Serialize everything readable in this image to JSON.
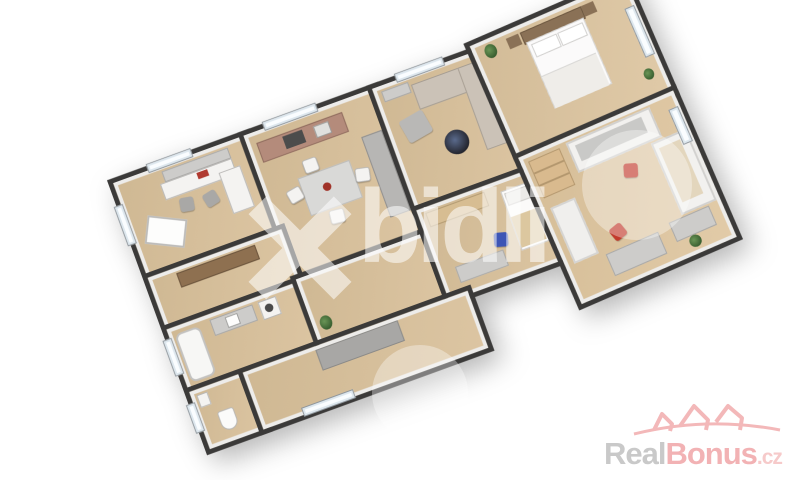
{
  "watermark": {
    "text": "bidli",
    "color": "#ffffff",
    "opacity": 0.55,
    "mark": "pinwheel-x-icon"
  },
  "logo": {
    "real": "Real",
    "bonus": "Bonus",
    "tld": ".cz",
    "real_color": "#c9c9c9",
    "bonus_color": "#f2b2b4",
    "tld_color": "#f6caca",
    "houses_color": "#f3b8b9",
    "icon": "three-houses-arc-icon"
  },
  "palette": {
    "background": "#ffffff",
    "wall": "#3b3a39",
    "inner_wall": "#edecea",
    "floor": "#d8c19d",
    "accent_red": "#c23a2c",
    "accent_blue": "#3d55b5",
    "sofa_beige": "#cbc2b7",
    "kitchen_counter": "#b48b7b",
    "wood_brown": "#8e7050"
  },
  "floorplan": {
    "type": "3d-rendered-floor-plan",
    "rotation_deg": -20,
    "rooms": [
      {
        "name": "office",
        "furniture": [
          "desk",
          "side-desk",
          "office-chairs",
          "leaning-whiteboard",
          "wall-shelf"
        ]
      },
      {
        "name": "kitchen-dining",
        "furniture": [
          "kitchen-counter",
          "stove",
          "dining-table",
          "four-chairs",
          "gray-sofa"
        ]
      },
      {
        "name": "living-room",
        "furniture": [
          "l-shaped-sofa",
          "armchair",
          "round-coffee-table",
          "sideboard"
        ]
      },
      {
        "name": "hallway",
        "furniture": [
          "wooden-sideboard"
        ]
      },
      {
        "name": "bathroom",
        "furniture": [
          "bathtub",
          "vanity-sink",
          "washing-machine"
        ]
      },
      {
        "name": "inner-hall",
        "furniture": [
          "plant"
        ]
      },
      {
        "name": "small-bedroom",
        "furniture": [
          "wardrobe",
          "single-bed",
          "desk",
          "blue-chair"
        ]
      },
      {
        "name": "wc",
        "furniture": [
          "toilet",
          "corner-sink"
        ]
      },
      {
        "name": "corridor",
        "furniture": [
          "doormat-rug"
        ]
      },
      {
        "name": "master-bedroom",
        "furniture": [
          "double-bed",
          "nightstands",
          "plants",
          "window"
        ]
      },
      {
        "name": "children-room",
        "furniture": [
          "loft-bed",
          "bunk-bed",
          "shelf-unit",
          "lounger",
          "desks",
          "red-chairs",
          "plant"
        ]
      }
    ]
  }
}
